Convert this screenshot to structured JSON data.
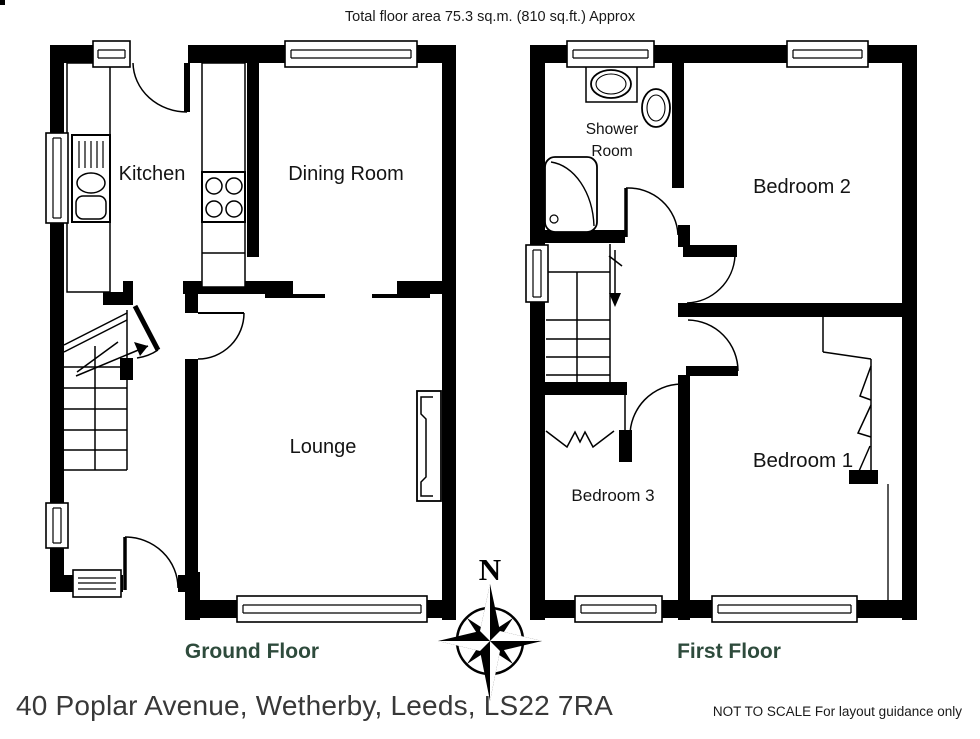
{
  "title": "Total floor area 75.3 sq.m. (810 sq.ft.) Approx",
  "ground_floor": {
    "label": "Ground Floor",
    "rooms": {
      "kitchen": "Kitchen",
      "dining": "Dining Room",
      "lounge": "Lounge"
    }
  },
  "first_floor": {
    "label": "First Floor",
    "rooms": {
      "shower": "Shower\nRoom",
      "bedroom2": "Bedroom 2",
      "bedroom3": "Bedroom 3",
      "bedroom1": "Bedroom 1"
    }
  },
  "compass": {
    "north": "N"
  },
  "footer": {
    "address": "40 Poplar Avenue, Wetherby, Leeds, LS22 7RA",
    "disclaimer": "NOT TO SCALE For layout guidance only"
  },
  "colors": {
    "wall": "#000000",
    "floor_label": "#2E4B3C",
    "address_text": "#383838"
  }
}
